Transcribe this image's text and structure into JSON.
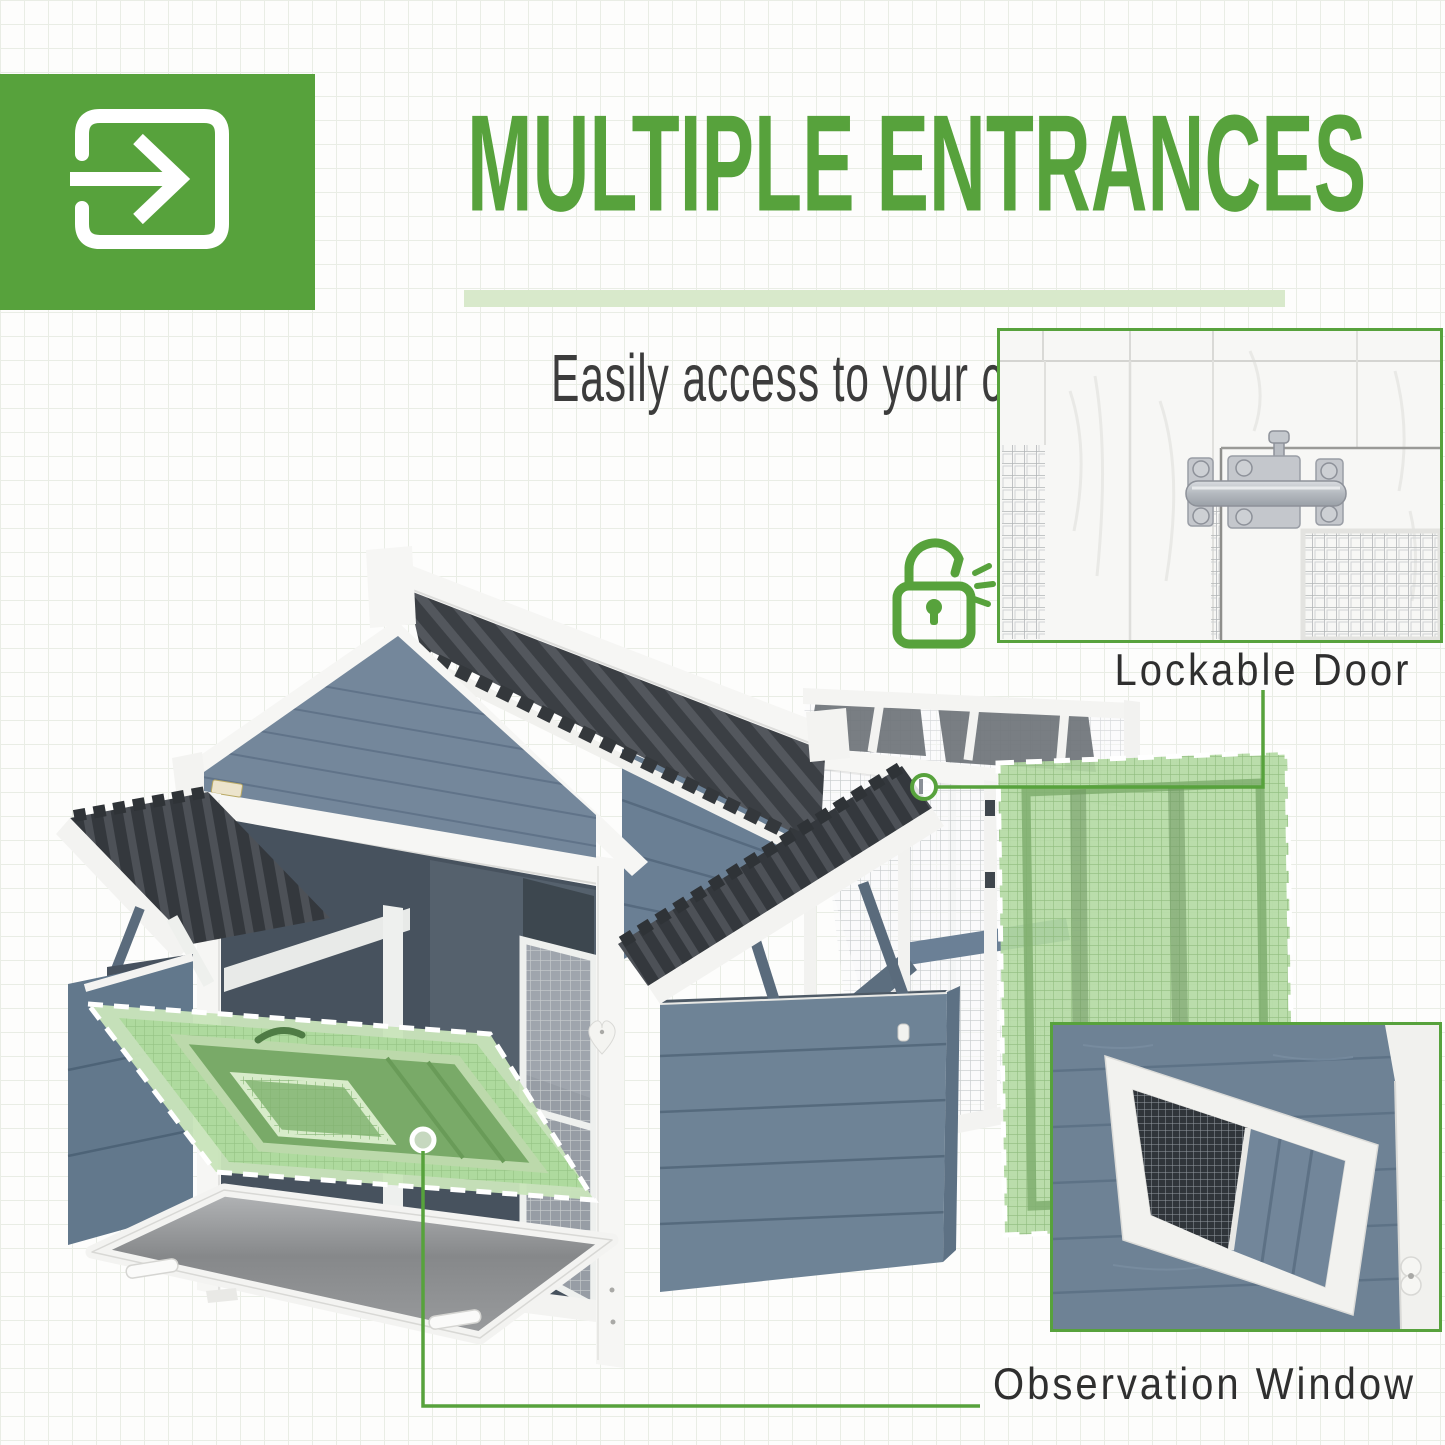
{
  "header": {
    "title": "MULTIPLE ENTRANCES",
    "subtitle": "Easily access to your chickens"
  },
  "callouts": {
    "lockable_door": "Lockable Door",
    "observation_window": "Observation Window"
  },
  "icons": {
    "entrance": "enter-arrow-icon",
    "lock": "open-padlock-icon",
    "latch_highlight": "latch-highlight-circle",
    "observation_point": "observation-point-dot"
  },
  "colors": {
    "accent_green": "#57a23c",
    "light_green_bar": "#d8e9cb",
    "highlight_green": "#aeda9e",
    "text_dark": "#2f2f2f",
    "coop_blue": "#74879b",
    "coop_blue_dark": "#677c91",
    "roof_dark": "#3b3f44",
    "wood_white": "#f6f6f4"
  }
}
